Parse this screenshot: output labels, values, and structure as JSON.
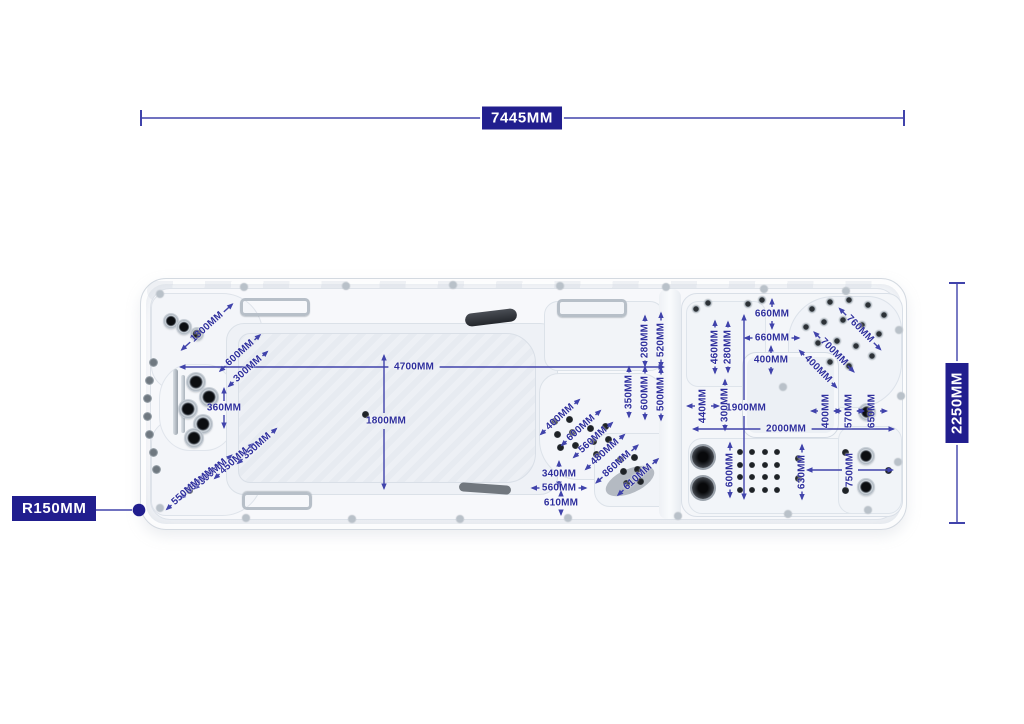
{
  "diagram_title": "swim spa top view dimension drawing",
  "colors": {
    "navy_box": "#211e8e",
    "dim_text": "#2e2f9d",
    "dim_line": "#4043ab",
    "shell": "#f7f8fa",
    "shell_border": "#d5dbe3"
  },
  "callouts": {
    "corner_radius": "R150MM",
    "overall_length": "7445MM",
    "overall_width": "2250MM"
  },
  "dimensions": [
    {
      "label": "7445MM",
      "type": "hline",
      "x1": 141,
      "x2": 904,
      "y": 118,
      "lx": 522,
      "boxed": true
    },
    {
      "label": "2250MM",
      "type": "vline",
      "x": 957,
      "y1": 283,
      "y2": 523,
      "ly": 403,
      "boxed": true
    },
    {
      "label": "4700MM",
      "type": "hline",
      "x1": 179,
      "x2": 665,
      "y": 367,
      "lx": 414
    },
    {
      "label": "1800MM",
      "type": "vline",
      "x": 384,
      "y1": 354,
      "y2": 490,
      "ly": 421
    },
    {
      "label": "1900MM",
      "type": "vline",
      "x": 744,
      "y1": 314,
      "y2": 500,
      "ly": 408
    },
    {
      "label": "2000MM",
      "type": "hline",
      "x1": 692,
      "x2": 895,
      "y": 429,
      "lx": 786
    },
    {
      "label": "360MM",
      "type": "v",
      "x": 224,
      "y": 408,
      "arm": 14
    },
    {
      "label": "340MM",
      "type": "v",
      "x": 559,
      "y": 474,
      "arm": 7
    },
    {
      "label": "560MM",
      "type": "h",
      "x": 559,
      "y": 488,
      "arm": 9
    },
    {
      "label": "610MM",
      "type": "v",
      "x": 561,
      "y": 503,
      "arm": 6
    },
    {
      "label": "660MM",
      "type": "v",
      "x": 772,
      "y": 314,
      "arm": 9
    },
    {
      "label": "660MM",
      "type": "h",
      "x": 772,
      "y": 338,
      "arm": 9
    },
    {
      "label": "400MM",
      "type": "v",
      "x": 771,
      "y": 360,
      "arm": 8
    },
    {
      "label": "280MM",
      "type": "vrot",
      "x": 645,
      "y": 341,
      "arm": 7
    },
    {
      "label": "520MM",
      "type": "vrot",
      "x": 661,
      "y": 340,
      "arm": 9
    },
    {
      "label": "350MM",
      "type": "vrot",
      "x": 629,
      "y": 392,
      "arm": 7
    },
    {
      "label": "600MM",
      "type": "vrot",
      "x": 645,
      "y": 393,
      "arm": 8
    },
    {
      "label": "500MM",
      "type": "vrot",
      "x": 661,
      "y": 394,
      "arm": 8
    },
    {
      "label": "460MM",
      "type": "vrot",
      "x": 715,
      "y": 347,
      "arm": 8
    },
    {
      "label": "280MM",
      "type": "vrot",
      "x": 728,
      "y": 347,
      "arm": 7
    },
    {
      "label": "300MM",
      "type": "vrot",
      "x": 725,
      "y": 405,
      "arm": 7
    },
    {
      "label": "440MM",
      "type": "hrot",
      "x": 703,
      "y": 406,
      "arm": 9
    },
    {
      "label": "600MM",
      "type": "vrot",
      "x": 730,
      "y": 470,
      "arm": 9
    },
    {
      "label": "630MM",
      "type": "vrot",
      "x": 802,
      "y": 472,
      "arm": 9
    },
    {
      "label": "750MM",
      "type": "hrot",
      "x": 850,
      "y": 470,
      "arm": 36
    },
    {
      "label": "400MM",
      "type": "hrot",
      "x": 826,
      "y": 411,
      "arm": 8
    },
    {
      "label": "570MM",
      "type": "hrot",
      "x": 849,
      "y": 411,
      "arm": 8
    },
    {
      "label": "650MM",
      "type": "hrot",
      "x": 872,
      "y": 411,
      "arm": 8
    },
    {
      "label": "1300MM",
      "type": "diag",
      "x": 207,
      "y": 327,
      "angle": -42,
      "arm": 13
    },
    {
      "label": "600MM",
      "type": "diag",
      "x": 240,
      "y": 353,
      "angle": -42,
      "arm": 9
    },
    {
      "label": "300MM",
      "type": "diag",
      "x": 248,
      "y": 369,
      "angle": -42,
      "arm": 8
    },
    {
      "label": "350MM",
      "type": "diag",
      "x": 257,
      "y": 446,
      "angle": -42,
      "arm": 8
    },
    {
      "label": "450MM",
      "type": "diag",
      "x": 234,
      "y": 461,
      "angle": -42,
      "arm": 8
    },
    {
      "label": "300MM",
      "type": "diag",
      "x": 213,
      "y": 472,
      "angle": -42,
      "arm": 7
    },
    {
      "label": "650MM",
      "type": "diag",
      "x": 200,
      "y": 481,
      "angle": -42,
      "arm": 8
    },
    {
      "label": "550MM",
      "type": "diag",
      "x": 186,
      "y": 492,
      "angle": -42,
      "arm": 8
    },
    {
      "label": "400MM",
      "type": "diag",
      "x": 560,
      "y": 417,
      "angle": -42,
      "arm": 8
    },
    {
      "label": "600MM",
      "type": "diag",
      "x": 581,
      "y": 428,
      "angle": -42,
      "arm": 8
    },
    {
      "label": "560MM",
      "type": "diag",
      "x": 593,
      "y": 440,
      "angle": -42,
      "arm": 8
    },
    {
      "label": "480MM",
      "type": "diag",
      "x": 605,
      "y": 452,
      "angle": -42,
      "arm": 8
    },
    {
      "label": "860MM",
      "type": "diag",
      "x": 617,
      "y": 464,
      "angle": -42,
      "arm": 10
    },
    {
      "label": "610MM",
      "type": "diag",
      "x": 638,
      "y": 477,
      "angle": -42,
      "arm": 9
    },
    {
      "label": "760MM",
      "type": "diag",
      "x": 860,
      "y": 329,
      "angle": 45,
      "arm": 11
    },
    {
      "label": "700MM",
      "type": "diag",
      "x": 834,
      "y": 352,
      "angle": 45,
      "arm": 10
    },
    {
      "label": "400MM",
      "type": "diag",
      "x": 818,
      "y": 369,
      "angle": 45,
      "arm": 8
    }
  ]
}
